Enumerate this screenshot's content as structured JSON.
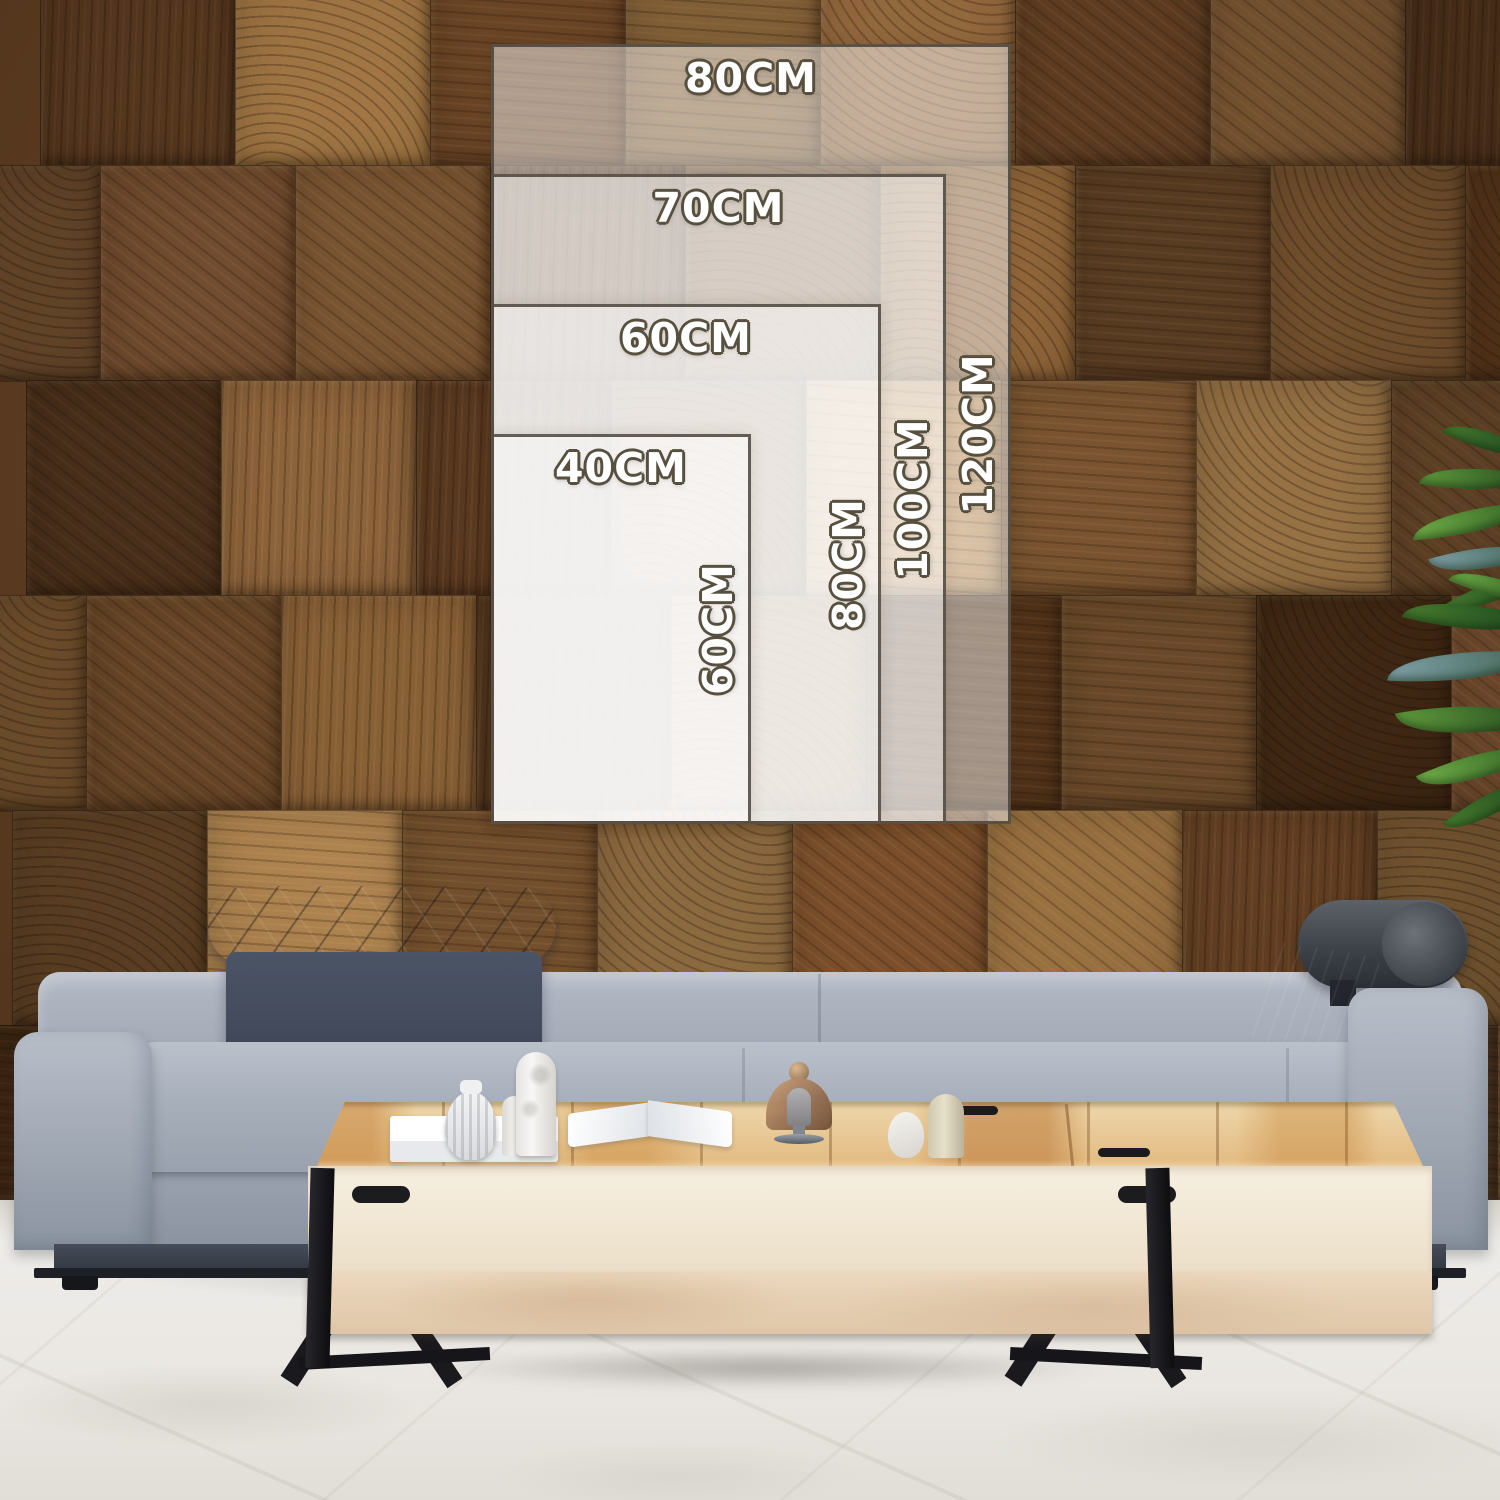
{
  "size_guide": {
    "unit": "CM",
    "scale_px_per_cm": 6.5,
    "anchor": {
      "left_px": 491,
      "bottom_px": 824
    },
    "frame_fill": "rgba(255,255,255,0.48)",
    "frame_border_color": "#48423a",
    "label_text_color": "#ffffff",
    "label_outline_color": "#57503f",
    "sizes": [
      {
        "width_cm": 80,
        "height_cm": 120,
        "width_label": "80CM",
        "height_label": "120CM"
      },
      {
        "width_cm": 70,
        "height_cm": 100,
        "width_label": "70CM",
        "height_label": "100CM"
      },
      {
        "width_cm": 60,
        "height_cm": 80,
        "width_label": "60CM",
        "height_label": "80CM"
      },
      {
        "width_cm": 40,
        "height_cm": 60,
        "width_label": "40CM",
        "height_label": "60CM"
      }
    ]
  },
  "scene": {
    "wall": {
      "material": "end-grain-wood-blocks",
      "palette": [
        "#6b4526",
        "#7c5633",
        "#5a3a20",
        "#8a6137",
        "#75512e",
        "#4e3118",
        "#936c3e",
        "#67452a",
        "#7f5a35",
        "#5f4024",
        "#a07949",
        "#714e2c"
      ]
    },
    "floor_color": "#eae7e2",
    "sofa": {
      "fabric_color": "#a3abb8",
      "headrest_color": "#3d4452",
      "base_color": "#333943"
    },
    "table": {
      "top_wood_color": "#e3b378",
      "face_color": "#f1e9d8",
      "leg_color": "#17171a"
    },
    "plant_colors": [
      "#2b5222",
      "#477b2e",
      "#6fae47",
      "#7fa0a8"
    ]
  }
}
